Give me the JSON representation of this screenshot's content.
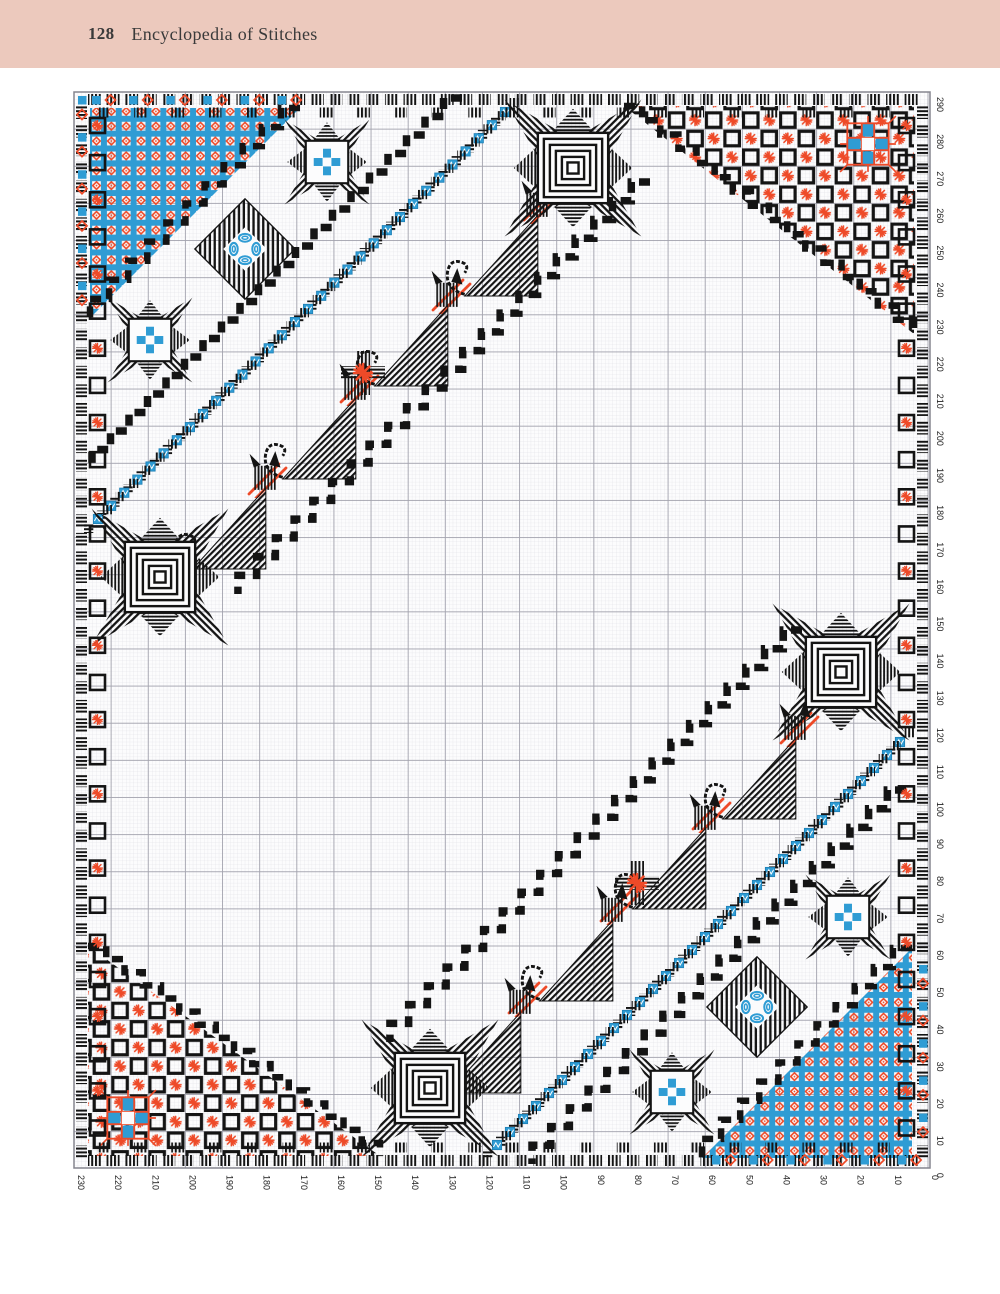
{
  "page": {
    "background": "#ffffff"
  },
  "header": {
    "band_color": "#ecc9bd",
    "text_color": "#3a3a3a",
    "page_number": "128",
    "title": "Encyclopedia of Stitches"
  },
  "chart": {
    "frame": {
      "x": 74,
      "y": 92,
      "w": 856,
      "h": 1076,
      "line_color": "#85858f"
    },
    "unit": 3.713,
    "grid": {
      "bg": "#fcfcfd",
      "minor_color": "#dddde3",
      "major_color": "#a3a3ae"
    },
    "palette": {
      "black": "#141414",
      "blue": "#2f9cd4",
      "red": "#ee4a28",
      "white": "#ffffff"
    },
    "axes": {
      "color": "#222222",
      "font_size": 9,
      "bottom": [
        "230",
        "220",
        "210",
        "200",
        "190",
        "180",
        "170",
        "160",
        "150",
        "140",
        "130",
        "120",
        "110",
        "100",
        "90",
        "80",
        "70",
        "60",
        "50",
        "40",
        "30",
        "20",
        "10",
        "0"
      ],
      "right": [
        "290",
        "280",
        "270",
        "260",
        "250",
        "240",
        "230",
        "220",
        "210",
        "200",
        "190",
        "180",
        "170",
        "160",
        "150",
        "140",
        "130",
        "120",
        "110",
        "100",
        "90",
        "80",
        "70",
        "60",
        "50",
        "40",
        "30",
        "20",
        "10",
        "0"
      ]
    },
    "chart_data": {
      "type": "embroidery-stitch-chart",
      "grid_size": {
        "width_stitches": 230,
        "height_stitches": 290
      },
      "description": "Hardanger-style counted-thread embroidery chart on graph paper, 230 x 290 squares. A border of black satin-stitch blocks with red eyelet bursts frames the design. Top-left and bottom-right corners hold triangles of blue lattice squares with red eyelets; top-right and bottom-left corners hold black block checkerboards with red star bursts and one blue four-petal flower each. Two diagonal bands of stylized black cats, red double straight stitches and a blue/black chequered ribbon cross the field, each anchored by large concentric-square stars; the centre is blank grid.",
      "big_stars": [
        [
          573,
          168
        ],
        [
          160,
          577
        ],
        [
          841,
          672
        ],
        [
          430,
          1088
        ]
      ],
      "small_stars": [
        [
          327,
          162
        ],
        [
          150,
          340
        ],
        [
          848,
          917
        ],
        [
          672,
          1092
        ]
      ],
      "diamond_motifs": [
        [
          245,
          249
        ],
        [
          757,
          1007
        ]
      ],
      "flower_motifs": [
        [
          868,
          144
        ],
        [
          128,
          1118
        ]
      ],
      "cross_bursts": [
        [
          363,
          373
        ],
        [
          637,
          883
        ]
      ],
      "bands": [
        {
          "cats": [
            [
              500,
              245
            ],
            [
              410,
              335
            ],
            [
              318,
              428
            ],
            [
              228,
              518
            ]
          ],
          "red_stitches": [
            [
              543,
              203
            ],
            [
              452,
              293
            ],
            [
              360,
              385
            ],
            [
              268,
              477
            ]
          ],
          "zigzag_edges": [
            [
              650,
              182,
              238,
              594
            ],
            [
              462,
              98,
              92,
              468
            ]
          ],
          "blue_strip": [
            505,
            112,
            98,
            519
          ]
        },
        {
          "cats": [
            [
              758,
              768
            ],
            [
              668,
              858
            ],
            [
              575,
              950
            ],
            [
              483,
              1042
            ]
          ],
          "red_stitches": [
            [
              800,
              726
            ],
            [
              712,
              812
            ],
            [
              620,
              904
            ],
            [
              528,
              996
            ]
          ],
          "zigzag_edges": [
            [
              802,
              630,
              390,
              1042
            ],
            [
              906,
              790,
              532,
              1164
            ]
          ],
          "blue_strip": [
            900,
            742,
            497,
            1145
          ]
        }
      ],
      "lattice_corners": [
        [
          90,
          108,
          300,
          108,
          90,
          318
        ],
        [
          912,
          948,
          912,
          1158,
          702,
          1158
        ]
      ],
      "checker_corners": [
        [
          624,
          106,
          914,
          106,
          914,
          334
        ],
        [
          88,
          946,
          88,
          1156,
          380,
          1156
        ]
      ],
      "stair_edges": [
        [
          300,
          108,
          90,
          318
        ],
        [
          912,
          948,
          702,
          1158
        ],
        [
          624,
          106,
          914,
          334
        ],
        [
          88,
          946,
          380,
          1156
        ]
      ],
      "corner_accents": [
        {
          "edge": "top",
          "from": 92,
          "to": 285,
          "at": 96
        },
        {
          "edge": "left",
          "from": 96,
          "to": 285,
          "at": 78
        },
        {
          "edge": "bottom",
          "from": 712,
          "to": 906,
          "at": 1156
        },
        {
          "edge": "right",
          "from": 965,
          "to": 1150,
          "at": 919
        }
      ]
    }
  }
}
